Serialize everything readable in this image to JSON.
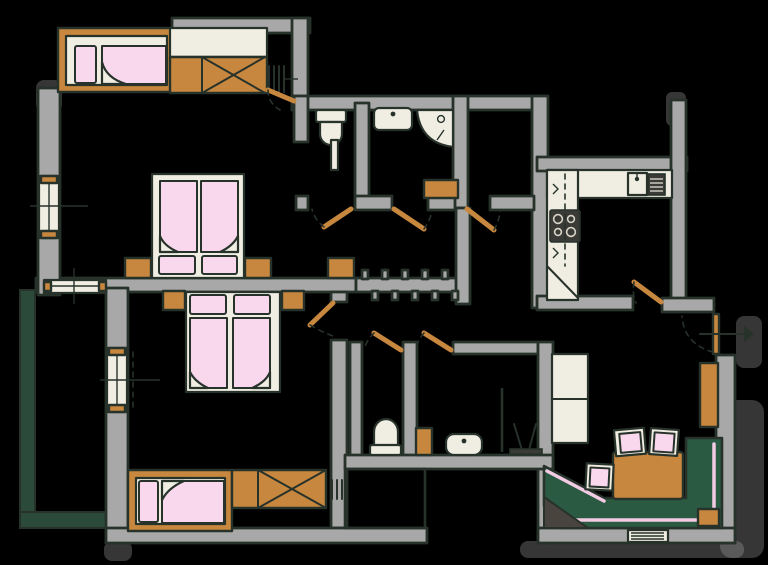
{
  "title": "Hand-drawn apartment floor plan",
  "colors": {
    "wall": "#a8a8a8",
    "outline": "#27322b",
    "wood": "#c8873e",
    "linen": "#f9d8ee",
    "base": "#f0ede2",
    "sofa": "#2b5a43",
    "railing": "#2c4a39",
    "dark-item": "#4a443f",
    "appliance": "#3a3a36",
    "trim": "#f3cce4",
    "bg": "#000000"
  },
  "rooms": [
    {
      "name": "bedroom-top-left",
      "furniture": [
        "single-bed",
        "wardrobe-with-x",
        "radiator",
        "double-bed",
        "nightstand-left",
        "nightstand-right",
        "dresser",
        "window",
        "door"
      ]
    },
    {
      "name": "bedroom-bottom-left",
      "furniture": [
        "double-bed",
        "nightstand-left",
        "nightstand-right",
        "single-bed",
        "wardrobe-with-x",
        "radiator",
        "window",
        "door"
      ]
    },
    {
      "name": "balcony",
      "furniture": [
        "railing"
      ]
    },
    {
      "name": "wc-top",
      "furniture": [
        "toilet",
        "pipe-duct",
        "door"
      ]
    },
    {
      "name": "bathroom-top",
      "furniture": [
        "washbasin",
        "corner-shower",
        "cabinet",
        "door"
      ]
    },
    {
      "name": "storage-room",
      "furniture": [
        "door"
      ]
    },
    {
      "name": "kitchen",
      "furniture": [
        "l-shaped-counter",
        "sink",
        "drainer",
        "cooktop",
        "upper-cabinets-dashed",
        "corner-cabinet",
        "door"
      ]
    },
    {
      "name": "hallway",
      "furniture": [
        "entrance-door",
        "tall-cabinet",
        "coat-rack-wall"
      ]
    },
    {
      "name": "wc-bottom",
      "furniture": [
        "toilet",
        "door"
      ]
    },
    {
      "name": "bathroom-bottom",
      "furniture": [
        "washbasin",
        "cabinet",
        "shower-screen",
        "radiator",
        "door"
      ]
    },
    {
      "name": "living-dining",
      "furniture": [
        "corner-sofa",
        "sofa-side-unit",
        "corner-table",
        "dining-table",
        "chair",
        "chair",
        "chair",
        "shelf-cabinet",
        "window-radiator"
      ]
    }
  ],
  "legend": {
    "pink": "beds, bedding, chair cushions, sofa piping",
    "orange": "wooden furniture and door leaves",
    "green": "sofa and balcony railing",
    "gray": "walls",
    "cream": "sanitary fixtures and kitchen counter"
  }
}
